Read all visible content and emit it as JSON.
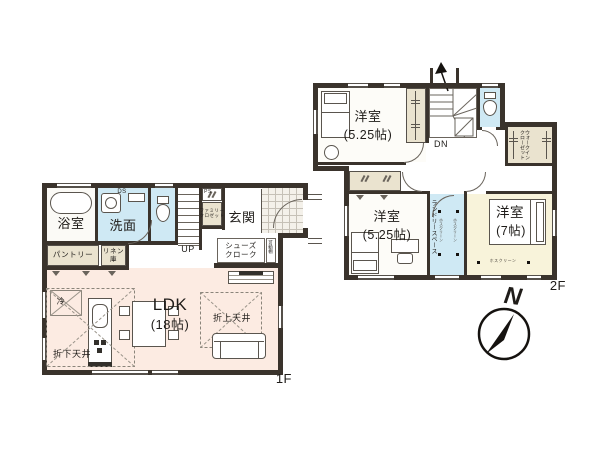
{
  "colors": {
    "wall": "#3a332c",
    "wet_room_floor": "#cfe9f4",
    "closet_floor": "#eae3cf",
    "ldk_floor": "#fcebe2",
    "bedroom7_floor": "#f8f3da"
  },
  "floor1": {
    "floor_label": "1F",
    "bath": {
      "label": "浴室"
    },
    "washroom": {
      "label": "洗面",
      "duct_label": "DS"
    },
    "stairs": {
      "label": "UP"
    },
    "pipe_space": {
      "label": "PS"
    },
    "family_closet": {
      "line1": "ファミリー",
      "line2": "クロゼット"
    },
    "entrance": {
      "label": "玄関"
    },
    "shoe_closet": {
      "line1": "シューズ",
      "line2": "クローク"
    },
    "movable_shelf": {
      "label": "可動棚"
    },
    "pantry": {
      "label": "パントリー"
    },
    "linen": {
      "line1": "リネン",
      "line2": "庫"
    },
    "ldk": {
      "name": "LDK",
      "size": "(18帖)"
    },
    "refrigerator": {
      "label": "冷"
    },
    "lowered_ceiling": {
      "label": "折下天井"
    },
    "raised_ceiling": {
      "label": "折上天井"
    }
  },
  "floor2": {
    "floor_label": "2F",
    "stairs": {
      "label": "DN"
    },
    "bedroom1": {
      "name": "洋室",
      "size": "(5.25帖)"
    },
    "bedroom2": {
      "name": "洋室",
      "size": "(5.25帖)"
    },
    "bedroom3": {
      "name": "洋室",
      "size": "(7帖)"
    },
    "walk_in_closet": {
      "line1": "ウォークイン",
      "line2": "クローゼット"
    },
    "laundry": {
      "label": "ランドリースペース"
    },
    "hoist": {
      "label": "ホスクリーン"
    }
  },
  "compass": {
    "north_label": "N"
  }
}
